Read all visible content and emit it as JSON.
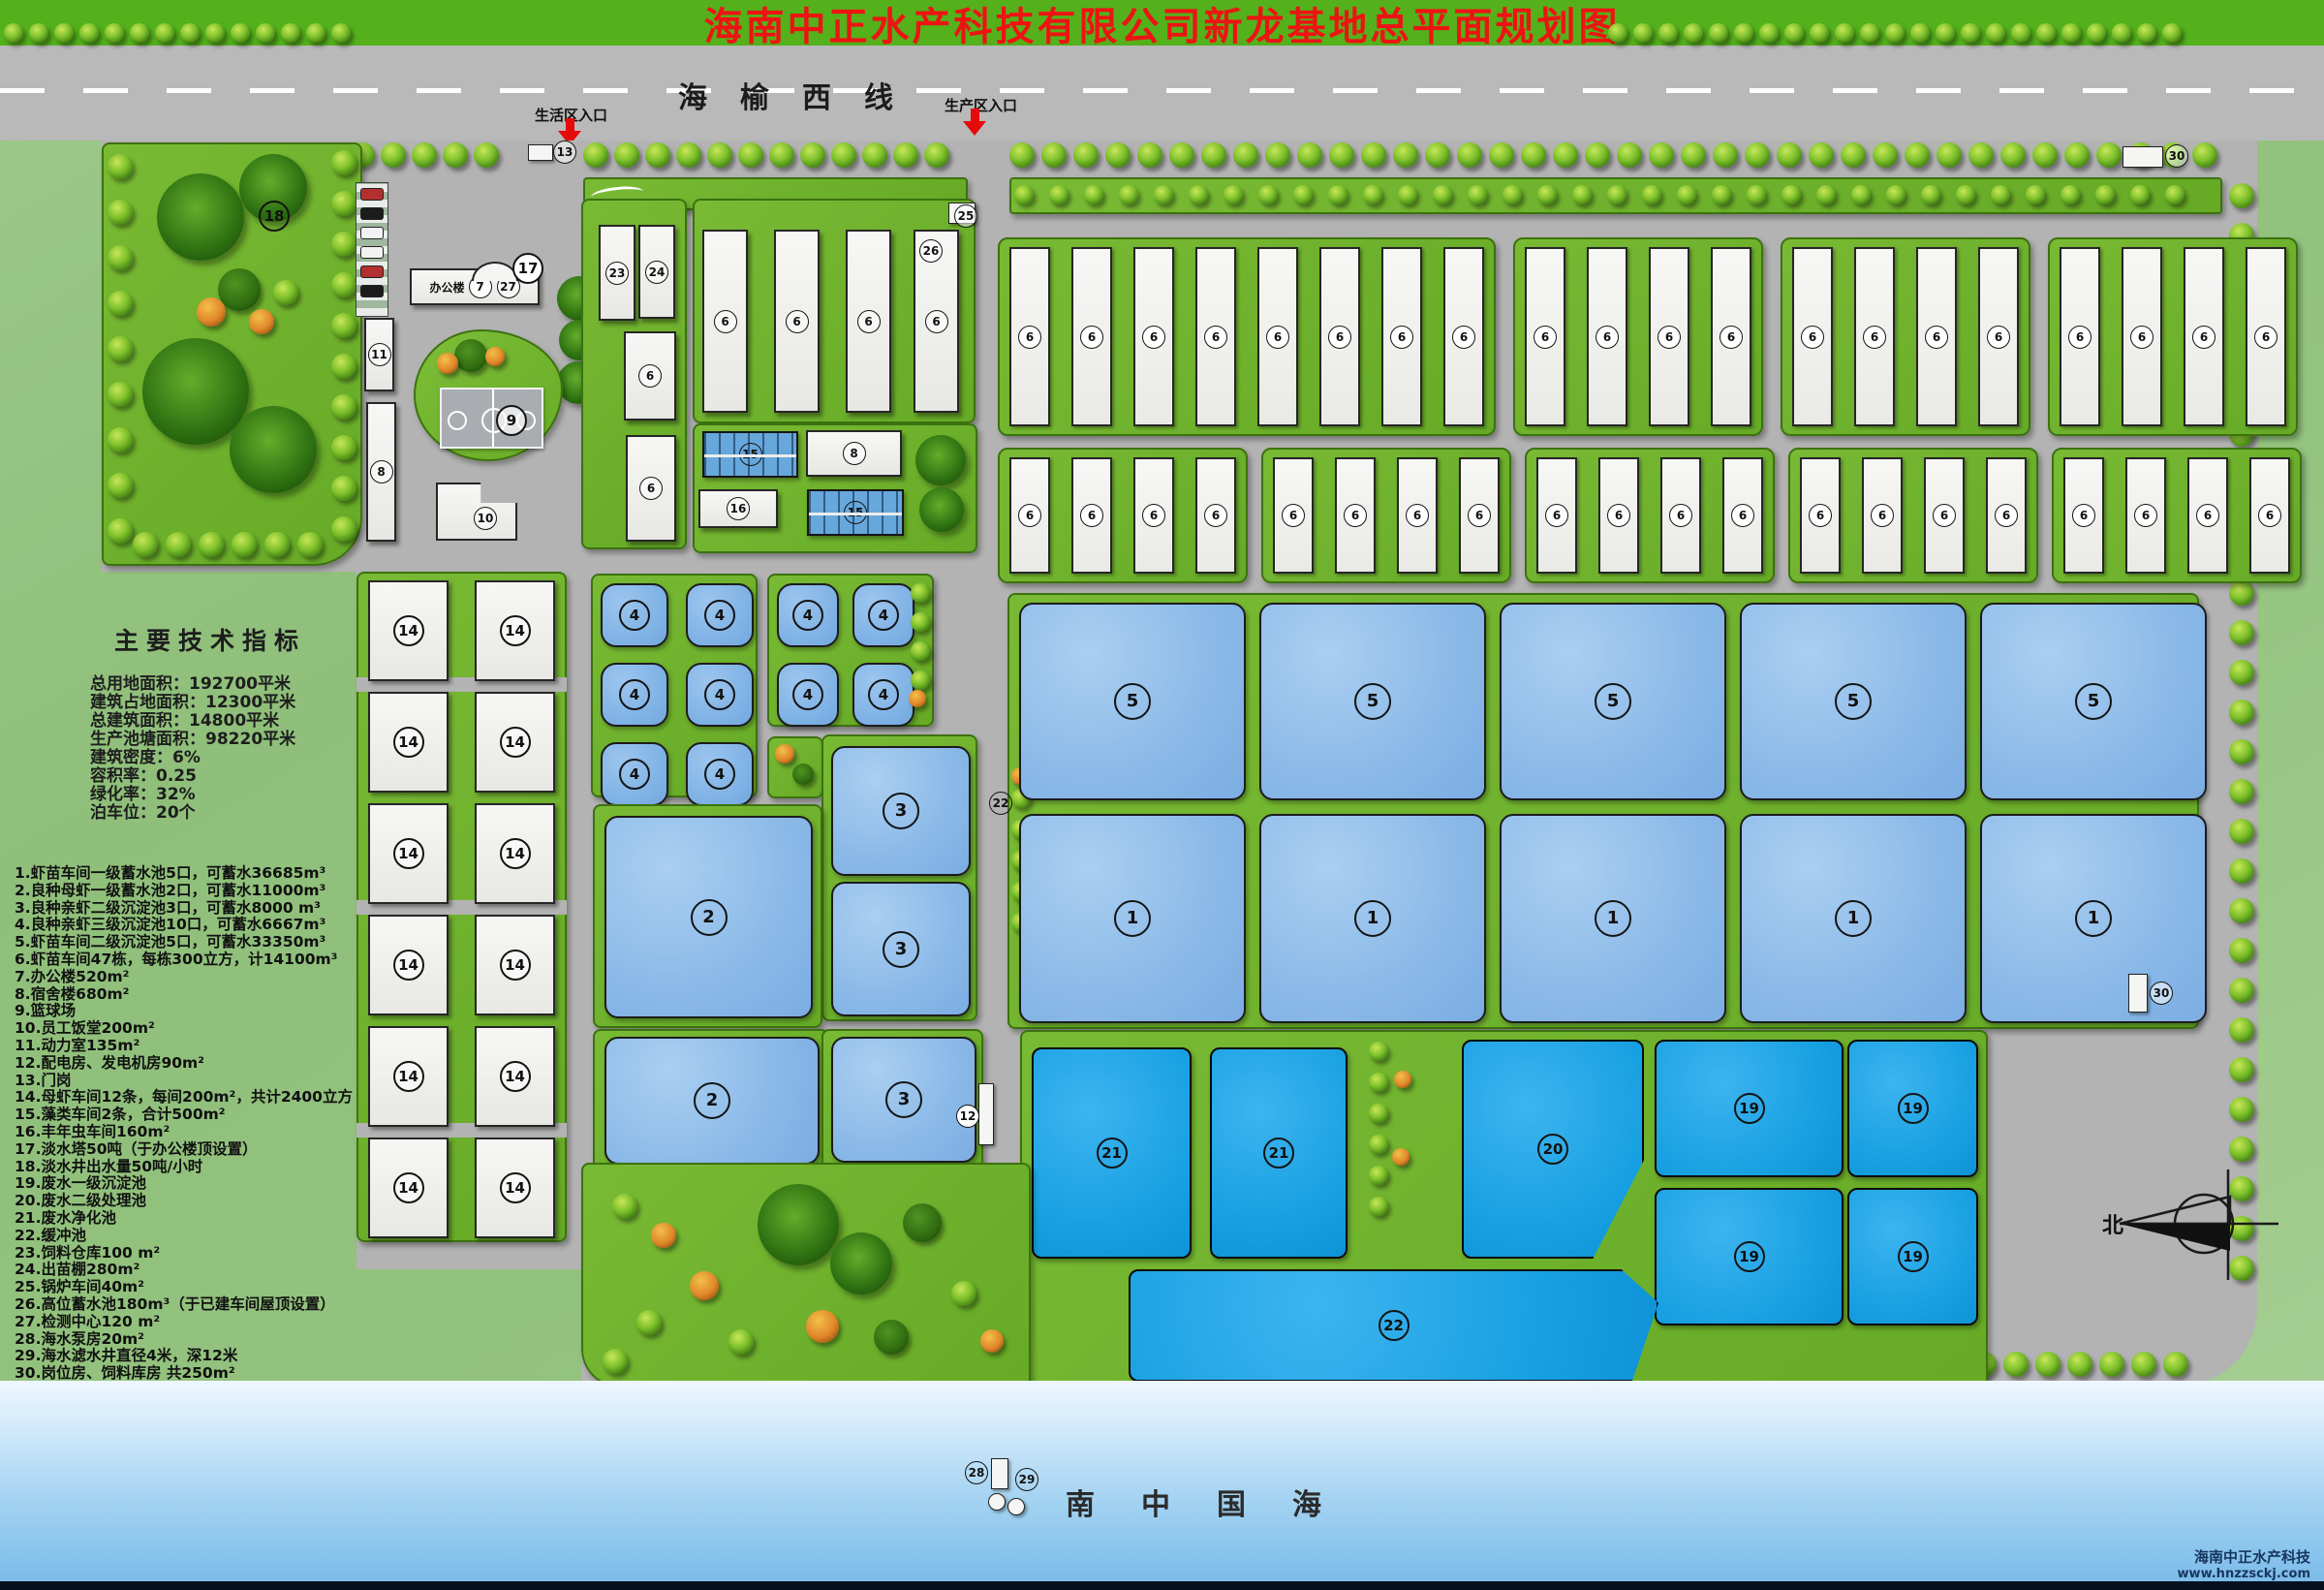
{
  "title": "海南中正水产科技有限公司新龙基地总平面规划图",
  "top_road": {
    "name": "海榆西线",
    "entrance_living": "生活区入口",
    "entrance_production": "生产区入口"
  },
  "indicators": {
    "heading": "主要技术指标",
    "lines": [
      "总用地面积：192700平米",
      "建筑占地面积：12300平米",
      "总建筑面积：14800平米",
      "生产池塘面积：98220平米",
      "建筑密度：6%",
      "容积率：0.25",
      "绿化率：32%",
      "泊车位：20个"
    ]
  },
  "legend": {
    "items": [
      "1.虾苗车间一级蓄水池5口，可蓄水36685m³",
      "2.良种母虾一级蓄水池2口，可蓄水11000m³",
      "3.良种亲虾二级沉淀池3口，可蓄水8000 m³",
      "4.良种亲虾三级沉淀池10口，可蓄水6667m³",
      "5.虾苗车间二级沉淀池5口，可蓄水33350m³",
      "6.虾苗车间47栋，每栋300立方，计14100m³",
      "7.办公楼520m²",
      "8.宿舍楼680m²",
      "9.篮球场",
      "10.员工饭堂200m²",
      "11.动力室135m²",
      "12.配电房、发电机房90m²",
      "13.门岗",
      "14.母虾车间12条，每间200m²，共计2400立方",
      "15.藻类车间2条，合计500m²",
      "16.丰年虫车间160m²",
      "17.淡水塔50吨（于办公楼顶设置）",
      "18.淡水井出水量50吨/小时",
      "19.废水一级沉淀池",
      "20.废水二级处理池",
      "21.废水净化池",
      "22.缓冲池",
      "23.饲料仓库100 m²",
      "24.出苗棚280m²",
      "25.锅炉车间40m²",
      "26.高位蓄水池180m³（于已建车间屋顶设置）",
      "27.检测中心120 m²",
      "28.海水泵房20m²",
      "29.海水滤水井直径4米，深12米",
      "30.岗位房、饲料库房 共250m²"
    ]
  },
  "map_labels": {
    "n1": "1",
    "n2": "2",
    "n3": "3",
    "n4": "4",
    "n5": "5",
    "n6": "6",
    "n7": "7",
    "n8": "8",
    "n9": "9",
    "n10": "10",
    "n11": "11",
    "n12": "12",
    "n13": "13",
    "n14": "14",
    "n15": "15",
    "n16": "16",
    "n17": "17",
    "n18": "18",
    "n19": "19",
    "n20": "20",
    "n21": "21",
    "n22": "22",
    "n23": "23",
    "n24": "24",
    "n25": "25",
    "n26": "26",
    "n27": "27",
    "n28": "28",
    "n29": "29",
    "n30": "30",
    "office_name": "办公楼"
  },
  "sea": {
    "name_chars": [
      "南",
      "中",
      "国",
      "海"
    ]
  },
  "compass": {
    "north_label": "北"
  },
  "branding": {
    "company": "海南中正水产科技",
    "website": "www.hnzzsckj.com"
  },
  "colors": {
    "title_green": "#54b11c",
    "title_red": "#ee1313",
    "road_gray": "#b9b9b9",
    "pond_light": "#8ab9e8",
    "pond_dark": "#17a0e2",
    "grass": "#6fb32b",
    "sea_blue": "#86c2ec"
  }
}
